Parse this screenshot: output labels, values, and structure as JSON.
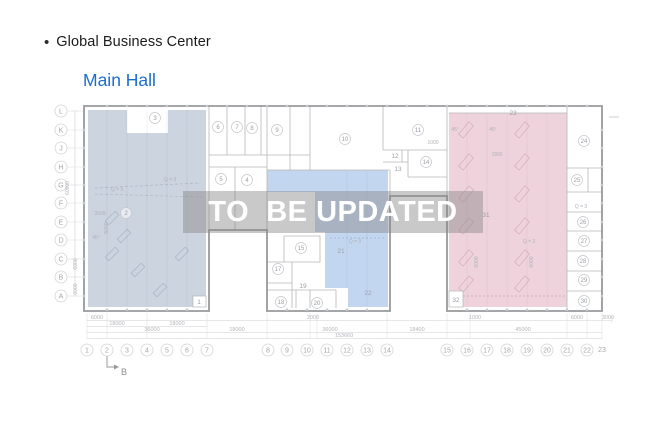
{
  "header": {
    "bullet": "•",
    "title": "Global Business Center",
    "subtitle": "Main Hall"
  },
  "watermark": {
    "text": "TO  BE UPDATED"
  },
  "colors": {
    "subtitle_blue": "#1a6dd0",
    "left_region": "#ccd4df",
    "middle_region": "#c3d6ef",
    "right_region": "#eed3dc",
    "watermark_bg": "rgba(136,136,136,0.45)"
  },
  "plan": {
    "axis_letters": [
      {
        "label": "L",
        "y": 111
      },
      {
        "label": "K",
        "y": 130
      },
      {
        "label": "J",
        "y": 148
      },
      {
        "label": "H",
        "y": 167
      },
      {
        "label": "G",
        "y": 185
      },
      {
        "label": "F",
        "y": 203
      },
      {
        "label": "E",
        "y": 222
      },
      {
        "label": "D",
        "y": 240
      },
      {
        "label": "C",
        "y": 259
      },
      {
        "label": "B",
        "y": 277
      },
      {
        "label": "A",
        "y": 296
      }
    ],
    "axis_numbers": [
      {
        "label": "1",
        "x": 87
      },
      {
        "label": "2",
        "x": 107
      },
      {
        "label": "3",
        "x": 127
      },
      {
        "label": "4",
        "x": 147
      },
      {
        "label": "5",
        "x": 167
      },
      {
        "label": "6",
        "x": 187
      },
      {
        "label": "7",
        "x": 207
      },
      {
        "label": "8",
        "x": 268
      },
      {
        "label": "9",
        "x": 287
      },
      {
        "label": "10",
        "x": 307
      },
      {
        "label": "11",
        "x": 327
      },
      {
        "label": "12",
        "x": 347
      },
      {
        "label": "13",
        "x": 367
      },
      {
        "label": "14",
        "x": 387
      },
      {
        "label": "15",
        "x": 447
      },
      {
        "label": "16",
        "x": 467
      },
      {
        "label": "17",
        "x": 487
      },
      {
        "label": "18",
        "x": 507
      },
      {
        "label": "19",
        "x": 527
      },
      {
        "label": "20",
        "x": 547
      },
      {
        "label": "21",
        "x": 567
      },
      {
        "label": "22",
        "x": 587
      },
      {
        "label": "23",
        "x": 602,
        "y": 352,
        "plain": true
      }
    ],
    "rooms": [
      {
        "label": "1",
        "x": 199,
        "y": 304,
        "plain": true
      },
      {
        "label": "2",
        "x": 126,
        "y": 213
      },
      {
        "label": "3",
        "x": 155,
        "y": 118
      },
      {
        "label": "5",
        "x": 221,
        "y": 179
      },
      {
        "label": "4",
        "x": 247,
        "y": 180
      },
      {
        "label": "6",
        "x": 218,
        "y": 127
      },
      {
        "label": "7",
        "x": 237,
        "y": 127
      },
      {
        "label": "8",
        "x": 252,
        "y": 128
      },
      {
        "label": "9",
        "x": 277,
        "y": 130
      },
      {
        "label": "10",
        "x": 345,
        "y": 139
      },
      {
        "label": "11",
        "x": 418,
        "y": 130
      },
      {
        "label": "12",
        "x": 395,
        "y": 158,
        "plain": true
      },
      {
        "label": "13",
        "x": 398,
        "y": 171,
        "plain": true
      },
      {
        "label": "14",
        "x": 426,
        "y": 162
      },
      {
        "label": "15",
        "x": 301,
        "y": 248
      },
      {
        "label": "17",
        "x": 278,
        "y": 269
      },
      {
        "label": "18",
        "x": 281,
        "y": 302
      },
      {
        "label": "19",
        "x": 303,
        "y": 288,
        "plain": true
      },
      {
        "label": "20",
        "x": 317,
        "y": 303
      },
      {
        "label": "21",
        "x": 341,
        "y": 253,
        "plain": true
      },
      {
        "label": "22",
        "x": 368,
        "y": 295,
        "plain": true
      },
      {
        "label": "23",
        "x": 513,
        "y": 115,
        "plain": true
      },
      {
        "label": "24",
        "x": 584,
        "y": 141
      },
      {
        "label": "25",
        "x": 577,
        "y": 180
      },
      {
        "label": "26",
        "x": 583,
        "y": 222
      },
      {
        "label": "27",
        "x": 584,
        "y": 241
      },
      {
        "label": "28",
        "x": 583,
        "y": 261
      },
      {
        "label": "29",
        "x": 584,
        "y": 280
      },
      {
        "label": "30",
        "x": 584,
        "y": 301
      },
      {
        "label": "31",
        "x": 486,
        "y": 217,
        "plain": true
      },
      {
        "label": "32",
        "x": 456,
        "y": 302,
        "plain": true
      }
    ],
    "annotations": [
      {
        "text": "Q = 3",
        "x": 170,
        "y": 181
      },
      {
        "text": "Q = 3",
        "x": 117,
        "y": 191
      },
      {
        "text": "2600",
        "x": 100,
        "y": 215
      },
      {
        "text": "5000",
        "x": 108,
        "y": 228,
        "rot": true
      },
      {
        "text": "45°",
        "x": 96,
        "y": 239
      },
      {
        "text": "Q = 3",
        "x": 355,
        "y": 243
      },
      {
        "text": "45°",
        "x": 455,
        "y": 131
      },
      {
        "text": "45°",
        "x": 493,
        "y": 131
      },
      {
        "text": "1800",
        "x": 497,
        "y": 156
      },
      {
        "text": "1000",
        "x": 433,
        "y": 144
      },
      {
        "text": "Q = 3",
        "x": 529,
        "y": 243
      },
      {
        "text": "6000",
        "x": 478,
        "y": 262,
        "rot": true
      },
      {
        "text": "6000",
        "x": 533,
        "y": 262,
        "rot": true
      },
      {
        "text": "Q = 3",
        "x": 581,
        "y": 208
      },
      {
        "text": "60000",
        "x": 69,
        "y": 188,
        "rot": true
      },
      {
        "text": "6000",
        "x": 77,
        "y": 264,
        "rot": true
      },
      {
        "text": "6000",
        "x": 77,
        "y": 289,
        "rot": true
      }
    ],
    "dimensions": [
      {
        "text": "6000",
        "x": 97,
        "y": 319
      },
      {
        "text": "2000",
        "x": 313,
        "y": 319
      },
      {
        "text": "1000",
        "x": 475,
        "y": 319
      },
      {
        "text": "6000",
        "x": 577,
        "y": 319
      },
      {
        "text": "3000",
        "x": 608,
        "y": 319
      },
      {
        "text": "18000",
        "x": 117,
        "y": 325
      },
      {
        "text": "18000",
        "x": 177,
        "y": 325
      },
      {
        "text": "36000",
        "x": 152,
        "y": 331
      },
      {
        "text": "18000",
        "x": 237,
        "y": 331
      },
      {
        "text": "36000",
        "x": 330,
        "y": 331
      },
      {
        "text": "18400",
        "x": 417,
        "y": 331
      },
      {
        "text": "45000",
        "x": 523,
        "y": 331
      },
      {
        "text": "153660",
        "x": 344,
        "y": 337
      }
    ],
    "section_marker": {
      "label": "B"
    }
  }
}
